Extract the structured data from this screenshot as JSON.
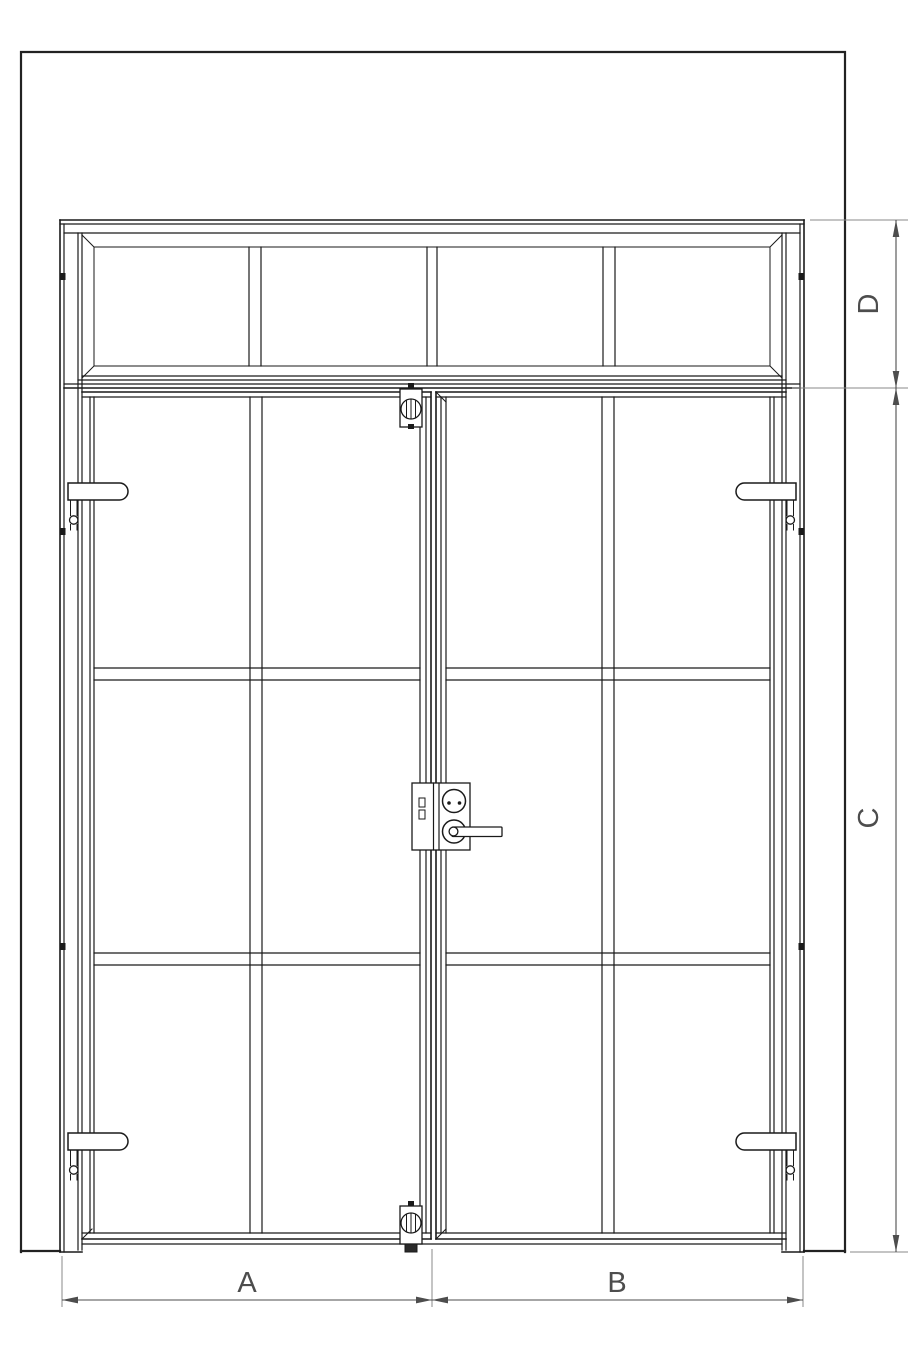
{
  "drawing": {
    "title": "double-door-with-transom-elevation",
    "dim_labels": {
      "a": "A",
      "b": "B",
      "c": "C",
      "d": "D"
    },
    "colors": {
      "line": "#1a1a1a",
      "dimension": "#4d4d4d",
      "extension": "#8a8a8a",
      "background": "#ffffff"
    },
    "components": {
      "wall": "wall-opening-outline",
      "frame": "door-frame",
      "transom": "transom-window-4-panes",
      "left_door": "left-door-leaf-2x3-panes",
      "right_door": "right-door-leaf-2x3-panes",
      "hinges": "four-barrel-hinges",
      "lock": "lock-cylinder-with-lever-handle",
      "flush_bolts": "top-and-bottom-flush-bolts"
    }
  }
}
